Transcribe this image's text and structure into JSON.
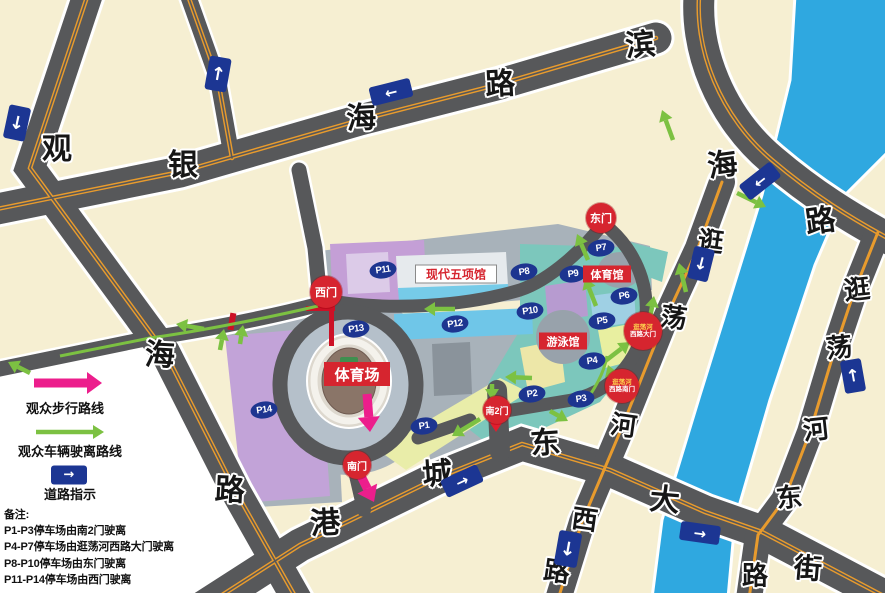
{
  "map": {
    "background_color": "#F6EFD2",
    "road_color": "#57585A",
    "water_color": "#2FA8E0",
    "gate_red": "#D6252F",
    "sign_blue": "#1C3693",
    "badge_navy": "#1D3590",
    "walking_route_color": "#EC1E8C",
    "vehicle_route_color": "#7CC142",
    "road_names": [
      "观海路",
      "银海路",
      "滨海路",
      "港城东大街",
      "逛荡河西路",
      "逛荡河东街"
    ]
  },
  "road_chars": [
    {
      "ch": "观",
      "x": 57,
      "y": 146,
      "s": 30,
      "rot": 0
    },
    {
      "ch": "银",
      "x": 183,
      "y": 162,
      "s": 30,
      "rot": 0
    },
    {
      "ch": "海",
      "x": 361,
      "y": 115,
      "s": 30,
      "rot": -3
    },
    {
      "ch": "路",
      "x": 500,
      "y": 81,
      "s": 30,
      "rot": -3
    },
    {
      "ch": "滨",
      "x": 640,
      "y": 42,
      "s": 30,
      "rot": -5
    },
    {
      "ch": "海",
      "x": 722,
      "y": 162,
      "s": 30,
      "rot": -8
    },
    {
      "ch": "路",
      "x": 820,
      "y": 218,
      "s": 30,
      "rot": -8
    },
    {
      "ch": "海",
      "x": 160,
      "y": 352,
      "s": 30,
      "rot": 3
    },
    {
      "ch": "路",
      "x": 230,
      "y": 487,
      "s": 30,
      "rot": 3
    },
    {
      "ch": "港",
      "x": 325,
      "y": 520,
      "s": 30,
      "rot": -4
    },
    {
      "ch": "城",
      "x": 437,
      "y": 471,
      "s": 30,
      "rot": -4
    },
    {
      "ch": "东",
      "x": 545,
      "y": 440,
      "s": 30,
      "rot": -4
    },
    {
      "ch": "大",
      "x": 665,
      "y": 497,
      "s": 30,
      "rot": 5
    },
    {
      "ch": "街",
      "x": 808,
      "y": 567,
      "s": 28,
      "rot": 5
    },
    {
      "ch": "逛",
      "x": 711,
      "y": 240,
      "s": 26,
      "rot": 8
    },
    {
      "ch": "荡",
      "x": 674,
      "y": 316,
      "s": 26,
      "rot": 8
    },
    {
      "ch": "河",
      "x": 624,
      "y": 424,
      "s": 26,
      "rot": 8
    },
    {
      "ch": "西",
      "x": 585,
      "y": 518,
      "s": 26,
      "rot": 8
    },
    {
      "ch": "路",
      "x": 557,
      "y": 570,
      "s": 26,
      "rot": 8
    },
    {
      "ch": "逛",
      "x": 857,
      "y": 288,
      "s": 26,
      "rot": -6
    },
    {
      "ch": "荡",
      "x": 839,
      "y": 346,
      "s": 26,
      "rot": -6
    },
    {
      "ch": "河",
      "x": 816,
      "y": 428,
      "s": 26,
      "rot": -6
    },
    {
      "ch": "东",
      "x": 789,
      "y": 496,
      "s": 26,
      "rot": -6
    },
    {
      "ch": "路",
      "x": 755,
      "y": 574,
      "s": 26,
      "rot": 0
    }
  ],
  "parking_badges": [
    {
      "id": "P1",
      "x": 424,
      "y": 426
    },
    {
      "id": "P2",
      "x": 532,
      "y": 394
    },
    {
      "id": "P3",
      "x": 581,
      "y": 399
    },
    {
      "id": "P4",
      "x": 592,
      "y": 361
    },
    {
      "id": "P5",
      "x": 602,
      "y": 321
    },
    {
      "id": "P6",
      "x": 624,
      "y": 296
    },
    {
      "id": "P7",
      "x": 601,
      "y": 248
    },
    {
      "id": "P8",
      "x": 524,
      "y": 272
    },
    {
      "id": "P9",
      "x": 573,
      "y": 274
    },
    {
      "id": "P10",
      "x": 530,
      "y": 311
    },
    {
      "id": "P11",
      "x": 383,
      "y": 270
    },
    {
      "id": "P12",
      "x": 455,
      "y": 324
    },
    {
      "id": "P13",
      "x": 356,
      "y": 329
    },
    {
      "id": "P14",
      "x": 264,
      "y": 410
    }
  ],
  "gates": [
    {
      "id": "west-gate",
      "label": "西门",
      "x": 326,
      "y": 292,
      "r": 16,
      "font": 11
    },
    {
      "id": "east-gate",
      "label": "东门",
      "x": 601,
      "y": 218,
      "r": 15,
      "font": 11
    },
    {
      "id": "south-gate",
      "label": "南门",
      "x": 357,
      "y": 465,
      "r": 14,
      "font": 10
    },
    {
      "id": "south-gate-2",
      "label": "南2门",
      "x": 497,
      "y": 410,
      "r": 14,
      "font": 9
    },
    {
      "id": "guangdang-west-road-main-gate",
      "lines": [
        "逛荡河",
        "西路大门"
      ],
      "x": 643,
      "y": 331,
      "r": 19,
      "font": 6.5
    },
    {
      "id": "guangdang-west-road-south-gate",
      "lines": [
        "逛荡河",
        "西路南门"
      ],
      "x": 622,
      "y": 386,
      "r": 17,
      "font": 6.5
    }
  ],
  "venue_labels": [
    {
      "id": "stadium",
      "label": "体育场",
      "x": 357,
      "y": 374,
      "w": 66,
      "h": 24,
      "font": 15,
      "style": "red"
    },
    {
      "id": "gymnasium",
      "label": "体育馆",
      "x": 607,
      "y": 274,
      "w": 48,
      "h": 17,
      "font": 11,
      "style": "red"
    },
    {
      "id": "swimming-hall",
      "label": "游泳馆",
      "x": 563,
      "y": 341,
      "w": 48,
      "h": 17,
      "font": 11,
      "style": "red"
    },
    {
      "id": "modern-pentathlon-hall",
      "label": "现代五项馆",
      "x": 456,
      "y": 274,
      "w": 80,
      "h": 17,
      "font": 12,
      "style": "white"
    }
  ],
  "traffic_signs": [
    {
      "dir": "down",
      "x": 17,
      "y": 123,
      "w": 22,
      "h": 34,
      "rot": 12
    },
    {
      "dir": "up",
      "x": 218,
      "y": 74,
      "w": 22,
      "h": 34,
      "rot": 10
    },
    {
      "dir": "left",
      "x": 391,
      "y": 92,
      "w": 42,
      "h": 19,
      "rot": -14
    },
    {
      "dir": "left",
      "x": 760,
      "y": 181,
      "w": 40,
      "h": 19,
      "rot": -38
    },
    {
      "dir": "down",
      "x": 701,
      "y": 264,
      "w": 21,
      "h": 33,
      "rot": 14
    },
    {
      "dir": "up",
      "x": 853,
      "y": 376,
      "w": 21,
      "h": 33,
      "rot": -10
    },
    {
      "dir": "down",
      "x": 568,
      "y": 549,
      "w": 23,
      "h": 35,
      "rot": 10
    },
    {
      "dir": "right",
      "x": 462,
      "y": 481,
      "w": 40,
      "h": 19,
      "rot": -25
    },
    {
      "dir": "right",
      "x": 700,
      "y": 533,
      "w": 40,
      "h": 19,
      "rot": 8
    }
  ],
  "arrows": {
    "green": [
      [
        455,
        309,
        424,
        309
      ],
      [
        532,
        378,
        505,
        377
      ],
      [
        588,
        260,
        577,
        234
      ],
      [
        596,
        306,
        585,
        278
      ],
      [
        604,
        362,
        630,
        342
      ],
      [
        616,
        388,
        608,
        365
      ],
      [
        650,
        318,
        654,
        296
      ],
      [
        686,
        292,
        679,
        263
      ],
      [
        673,
        140,
        662,
        110
      ],
      [
        737,
        193,
        766,
        207
      ],
      [
        204,
        329,
        176,
        324
      ],
      [
        220,
        350,
        224,
        329
      ],
      [
        240,
        344,
        243,
        325
      ],
      [
        30,
        373,
        8,
        362
      ],
      [
        492,
        384,
        492,
        400
      ],
      [
        480,
        419,
        452,
        436
      ],
      [
        550,
        411,
        568,
        421
      ],
      [
        36,
        432,
        104,
        432
      ]
    ],
    "magenta": [
      [
        367,
        394,
        370,
        432
      ],
      [
        360,
        474,
        374,
        502
      ],
      [
        34,
        383,
        102,
        383
      ]
    ],
    "red": [
      [
        496,
        400,
        496,
        432
      ]
    ]
  },
  "legend": {
    "walking_label": "观众步行路线",
    "vehicle_label": "观众车辆驶离路线",
    "sign_label": "道路指示",
    "sign_glyph": "→",
    "notes_title": "备注:",
    "notes": [
      "P1-P3停车场由南2门驶离",
      "P4-P7停车场由逛荡河西路大门驶离",
      "P8-P10停车场由东门驶离",
      "P11-P14停车场由西门驶离"
    ]
  }
}
